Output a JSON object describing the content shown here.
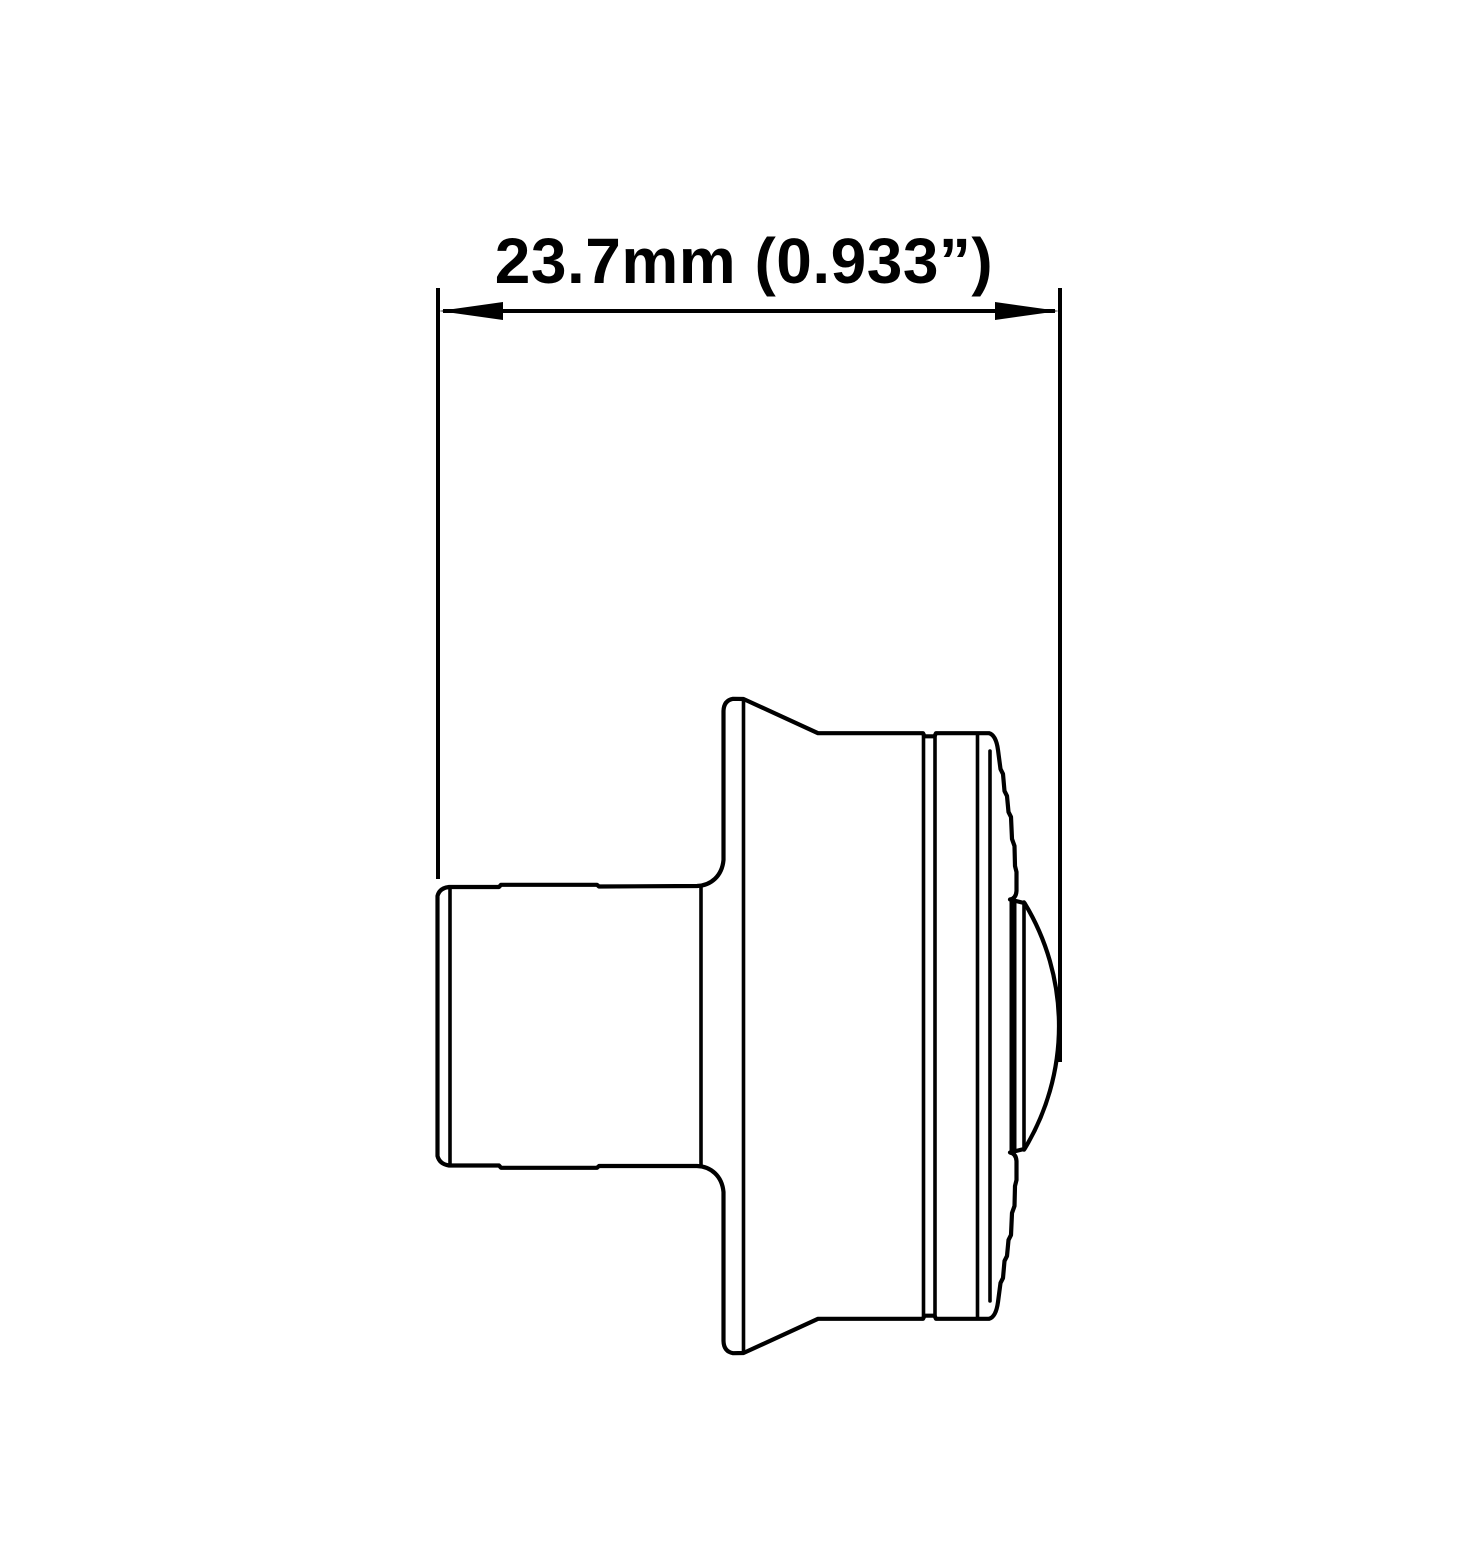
{
  "drawing": {
    "dimension": {
      "label": "23.7mm (0.933”)",
      "value_mm": "23.7mm",
      "value_inches": "0.933”"
    },
    "colors": {
      "ink": "#000000",
      "background": "#ffffff"
    }
  }
}
